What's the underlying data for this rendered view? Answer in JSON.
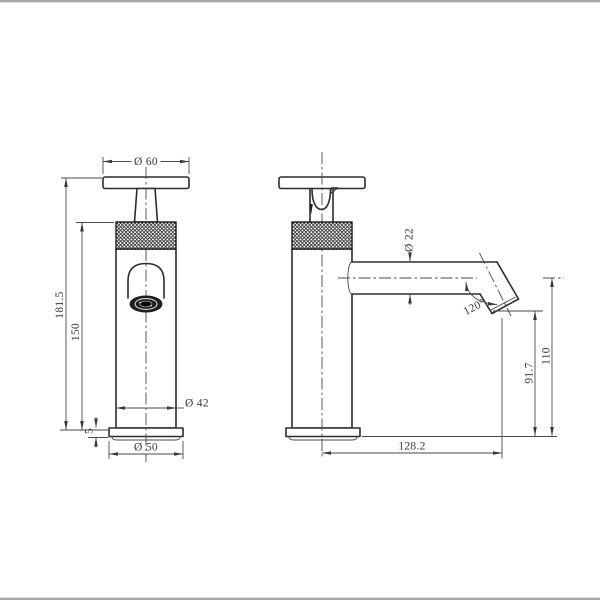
{
  "page": {
    "background": "#ffffff",
    "frame_line_color": "#a8a8a8"
  },
  "drawing": {
    "type": "technical-orthographic-drawing",
    "subject": "knurled pillar basin tap with angled spout, front and side views",
    "line_color": "#2d2d2d",
    "dimension_line_color": "#4a4a4a",
    "dimensions": {
      "handle_diameter": "Ø 60",
      "overall_height": "181.5",
      "body_height": "150",
      "base_height": "5",
      "body_diameter": "Ø 42",
      "base_diameter": "Ø 50",
      "spout_tube_diameter": "Ø 22",
      "spout_tip_angle": "120°",
      "outlet_height": "91.7",
      "spout_centerline_height": "110",
      "spout_reach": "128.2"
    }
  }
}
